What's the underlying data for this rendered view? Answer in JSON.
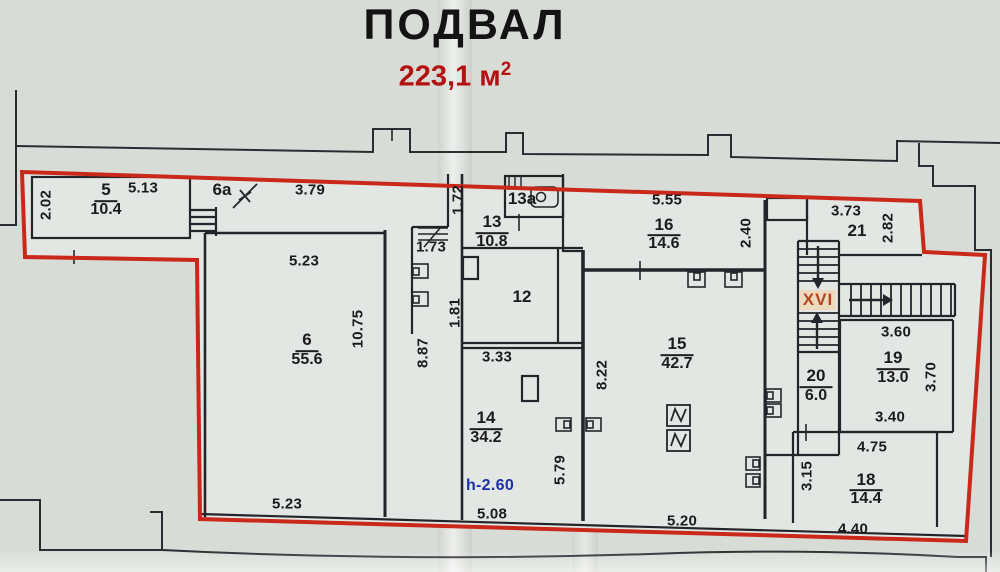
{
  "header": {
    "title": "ПОДВАЛ",
    "area_value": "223,1",
    "area_unit": "м",
    "area_sup": "2"
  },
  "colors": {
    "boundary_red": "#c9281a",
    "wall_black": "#23252b",
    "note_blue": "#1d2fa8",
    "stair_mark_red": "#b5451f",
    "title_black": "#131313",
    "subtitle_red": "#b31212",
    "paper": "#d8dcd6",
    "room_fill": "#e3e7e3"
  },
  "plan": {
    "rooms": [
      {
        "num": "5",
        "area": "10.4",
        "nx": 106,
        "ny": 187,
        "ax": 106,
        "ay": 213
      },
      {
        "num": "6",
        "area": "55.6",
        "nx": 307,
        "ny": 338,
        "ax": 307,
        "ay": 362
      },
      {
        "num": "13",
        "area": "10.8",
        "nx": 492,
        "ny": 221,
        "ax": 492,
        "ay": 243
      },
      {
        "num": "14",
        "area": "34.2",
        "nx": 486,
        "ny": 417,
        "ax": 486,
        "ay": 439
      },
      {
        "num": "15",
        "area": "42.7",
        "nx": 677,
        "ny": 343,
        "ax": 677,
        "ay": 365
      },
      {
        "num": "16",
        "area": "14.6",
        "nx": 664,
        "ny": 224,
        "ax": 664,
        "ay": 245
      },
      {
        "num": "18",
        "area": "14.4",
        "nx": 866,
        "ny": 479,
        "ax": 866,
        "ay": 500
      },
      {
        "num": "19",
        "area": "13.0",
        "nx": 893,
        "ny": 357,
        "ax": 893,
        "ay": 379
      },
      {
        "num": "20",
        "area": "6.0",
        "nx": 816,
        "ny": 375,
        "ax": 816,
        "ay": 397
      }
    ],
    "room_marks": [
      {
        "text": "12",
        "x": 522,
        "y": 297
      },
      {
        "text": "13a",
        "x": 522,
        "y": 199
      },
      {
        "text": "21",
        "x": 857,
        "y": 231
      },
      {
        "text": "6a",
        "x": 222,
        "y": 190
      }
    ],
    "dimensions": [
      {
        "text": "2.02",
        "x": 46,
        "y": 205,
        "rot": true
      },
      {
        "text": "5.13",
        "x": 143,
        "y": 188,
        "rot": false
      },
      {
        "text": "3.79",
        "x": 310,
        "y": 190,
        "rot": false
      },
      {
        "text": "1.72",
        "x": 458,
        "y": 200,
        "rot": true
      },
      {
        "text": "5.55",
        "x": 667,
        "y": 200,
        "rot": false
      },
      {
        "text": "3.73",
        "x": 846,
        "y": 211,
        "rot": false
      },
      {
        "text": "2.82",
        "x": 888,
        "y": 228,
        "rot": true
      },
      {
        "text": "5.23",
        "x": 304,
        "y": 261,
        "rot": false
      },
      {
        "text": "1.73",
        "x": 431,
        "y": 247,
        "rot": false
      },
      {
        "text": "2.40",
        "x": 746,
        "y": 233,
        "rot": true
      },
      {
        "text": "1.81",
        "x": 455,
        "y": 313,
        "rot": true
      },
      {
        "text": "10.75",
        "x": 358,
        "y": 329,
        "rot": true
      },
      {
        "text": "8.87",
        "x": 423,
        "y": 353,
        "rot": true
      },
      {
        "text": "3.33",
        "x": 497,
        "y": 357,
        "rot": false
      },
      {
        "text": "8.22",
        "x": 602,
        "y": 375,
        "rot": true
      },
      {
        "text": "3.60",
        "x": 896,
        "y": 332,
        "rot": false
      },
      {
        "text": "3.70",
        "x": 931,
        "y": 377,
        "rot": true
      },
      {
        "text": "3.40",
        "x": 890,
        "y": 417,
        "rot": false
      },
      {
        "text": "4.75",
        "x": 872,
        "y": 447,
        "rot": false
      },
      {
        "text": "3.15",
        "x": 807,
        "y": 476,
        "rot": true
      },
      {
        "text": "5.79",
        "x": 560,
        "y": 470,
        "rot": true
      },
      {
        "text": "5.08",
        "x": 492,
        "y": 514,
        "rot": false
      },
      {
        "text": "5.23",
        "x": 287,
        "y": 504,
        "rot": false
      },
      {
        "text": "5.20",
        "x": 682,
        "y": 521,
        "rot": false
      },
      {
        "text": "4.40",
        "x": 853,
        "y": 529,
        "rot": false
      }
    ],
    "notes": [
      {
        "text": "h-2.60",
        "x": 490,
        "y": 486,
        "style": "note-blue"
      },
      {
        "text": "XVI",
        "x": 818,
        "y": 300,
        "style": "mark-xvi"
      }
    ]
  }
}
